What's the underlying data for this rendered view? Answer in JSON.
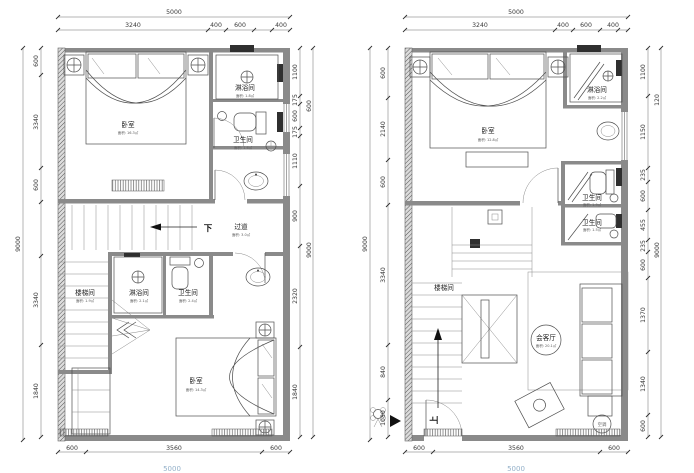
{
  "drawing": {
    "type": "apartment floor plans, two loft levels",
    "line_color": "#4f4f4f",
    "wall_color": "#8a8a8a",
    "dim_text_color": "#3a3a3a",
    "overall_dim_color": "#93b0c9"
  },
  "left_plan": {
    "dims_top": {
      "overall": "5000",
      "segments": [
        "3240",
        "400",
        "600",
        "400"
      ]
    },
    "dims_left": {
      "overall": "9000",
      "segments": [
        "600",
        "3340",
        "600",
        "3340",
        "1840"
      ]
    },
    "dims_right": {
      "outer": "9000",
      "spill": "600",
      "segments": [
        "1100",
        "175",
        "600",
        "175",
        "1110",
        "900",
        "2320",
        "1840"
      ]
    },
    "dims_bottom": {
      "overall": "5000",
      "segments": [
        "600",
        "3560",
        "600"
      ]
    },
    "rooms": {
      "bedroom_top": {
        "name": "卧室",
        "area": "面积: 16.3㎡"
      },
      "shower_top": {
        "name": "淋浴间",
        "area": "面积: 1.8㎡"
      },
      "bath_top": {
        "name": "卫生间",
        "area": "面积: 1.6㎡"
      },
      "corridor": {
        "name": "过道",
        "area": "面积: 3.0㎡"
      },
      "down_label": "下",
      "stairwell": {
        "name": "楼梯间",
        "area": "面积: 1.9㎡"
      },
      "shower_lower": {
        "name": "淋浴间",
        "area": "面积: 2.1㎡"
      },
      "bath_lower": {
        "name": "卫生间",
        "area": "面积: 2.4㎡"
      },
      "bedroom_lower": {
        "name": "卧室",
        "area": "面积: 14.3㎡"
      }
    }
  },
  "right_plan": {
    "dims_top": {
      "overall": "5000",
      "segments": [
        "3240",
        "400",
        "600",
        "400"
      ]
    },
    "dims_left": {
      "overall": "9000",
      "segments": [
        "600",
        "2140",
        "600",
        "3340",
        "840",
        "1080"
      ]
    },
    "dims_right": {
      "outer": "9000",
      "spill": "120",
      "segments": [
        "1100",
        "1150",
        "235",
        "600",
        "455",
        "235",
        "600",
        "1370",
        "1340",
        "600"
      ]
    },
    "dims_bottom": {
      "overall": "5000",
      "segments": [
        "600",
        "3560",
        "600"
      ]
    },
    "rooms": {
      "bedroom": {
        "name": "卧室",
        "area": "面积: 12.8㎡"
      },
      "shower": {
        "name": "淋浴间",
        "area": "面积: 2.2㎡"
      },
      "bath_upper": {
        "name": "卫生间",
        "area": "面积: 1.9㎡"
      },
      "bath_lower": {
        "name": "卫生间",
        "area": "面积: 1.5㎡"
      },
      "stairwell": {
        "name": "楼梯间"
      },
      "up_label": "上",
      "living": {
        "name": "会客厅",
        "area": "面积: 20.1㎡"
      },
      "ac_label": "空调"
    }
  }
}
